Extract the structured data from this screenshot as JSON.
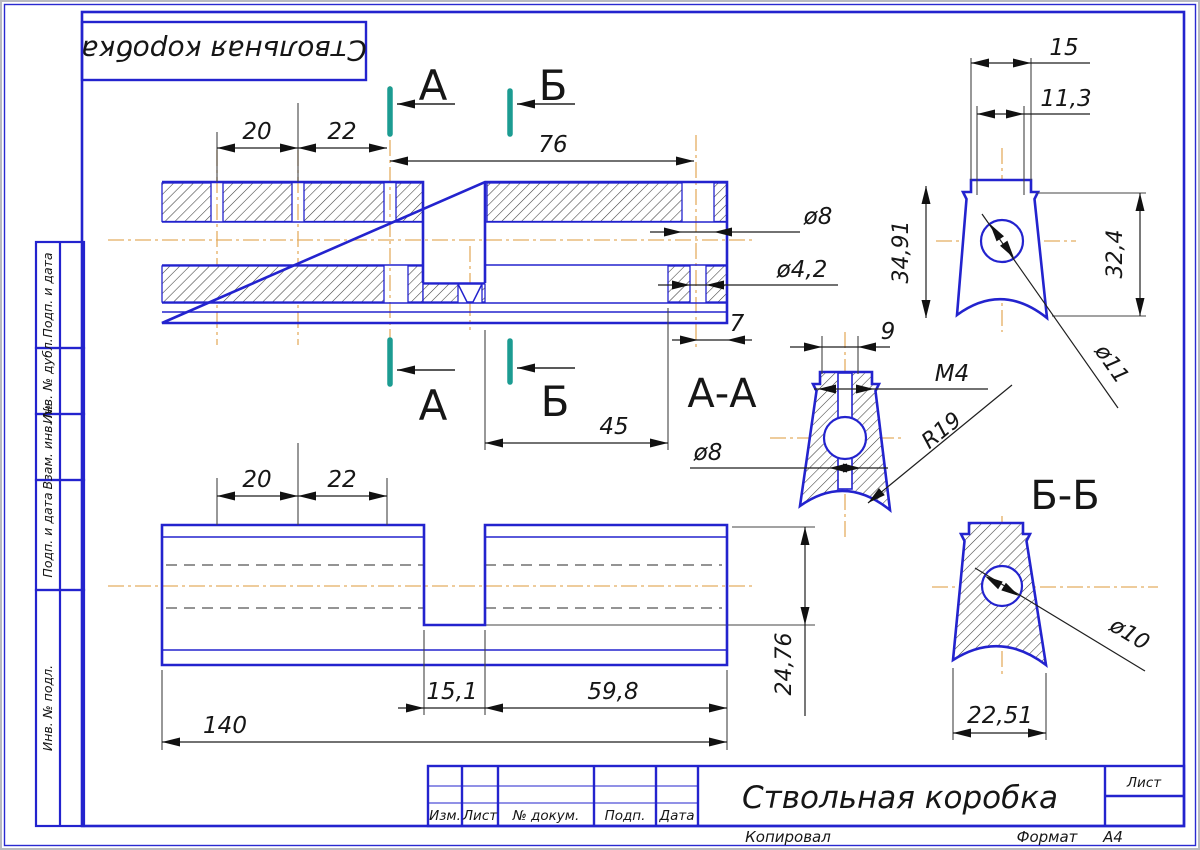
{
  "part_title": "Ствольная коробка",
  "colors": {
    "line_blue": "#2323CE",
    "section_mark_teal": "#1C9C92",
    "centerline_orange": "#E4AD62",
    "ink": "#161616"
  },
  "marks": {
    "a": "А",
    "b": "Б",
    "aa": "А-А",
    "bb": "Б-Б"
  },
  "dims": {
    "top_20": "20",
    "top_22": "22",
    "top_76": "76",
    "dia8_top": "ø8",
    "dia42": "ø4,2",
    "seven": "7",
    "front_15": "15",
    "front_113": "11,3",
    "front_3491": "34,91",
    "front_324": "32,4",
    "front_dia11": "ø11",
    "aa_9": "9",
    "aa_m4": "M4",
    "aa_dia8": "ø8",
    "aa_r19": "R19",
    "aa_45": "45",
    "bb_dia10": "ø10",
    "bb_2251": "22,51",
    "bot_20": "20",
    "bot_22": "22",
    "bot_151": "15,1",
    "bot_598": "59,8",
    "bot_140": "140",
    "bot_2476": "24,76"
  },
  "sidebar": {
    "items": [
      "Подп. и дата",
      "Инв. № дубл.",
      "Взам. инв. №",
      "Подп. и дата",
      "Инв. № подл."
    ]
  },
  "title_block": {
    "col_izm": "Изм.",
    "col_list": "Лист",
    "col_dokum": "№ докум.",
    "col_podp": "Подп.",
    "col_data": "Дата",
    "sheet_label": "Лист"
  },
  "footer": {
    "copied": "Копировал",
    "format_label": "Формат",
    "format_value": "A4"
  }
}
